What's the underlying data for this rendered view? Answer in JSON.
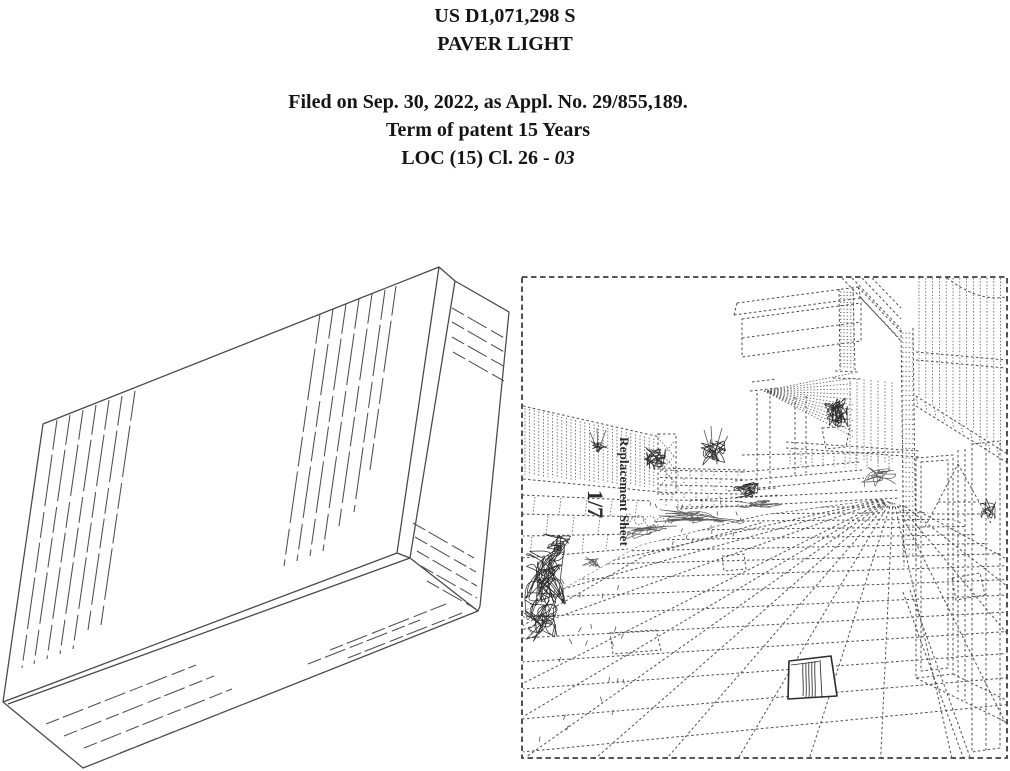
{
  "header": {
    "patent_number": "US D1,071,298 S",
    "title": "PAVER LIGHT",
    "filed_line": "Filed on Sep. 30, 2022, as Appl. No. 29/855,189.",
    "term_line": "Term of patent 15 Years",
    "loc_prefix": "LOC (15) Cl. 26 - ",
    "loc_class": "03"
  },
  "environment_figure": {
    "sheet_number": "1/7",
    "sheet_label": "Replacement Sheet"
  },
  "colors": {
    "background": "#ffffff",
    "ink": "#474747"
  }
}
